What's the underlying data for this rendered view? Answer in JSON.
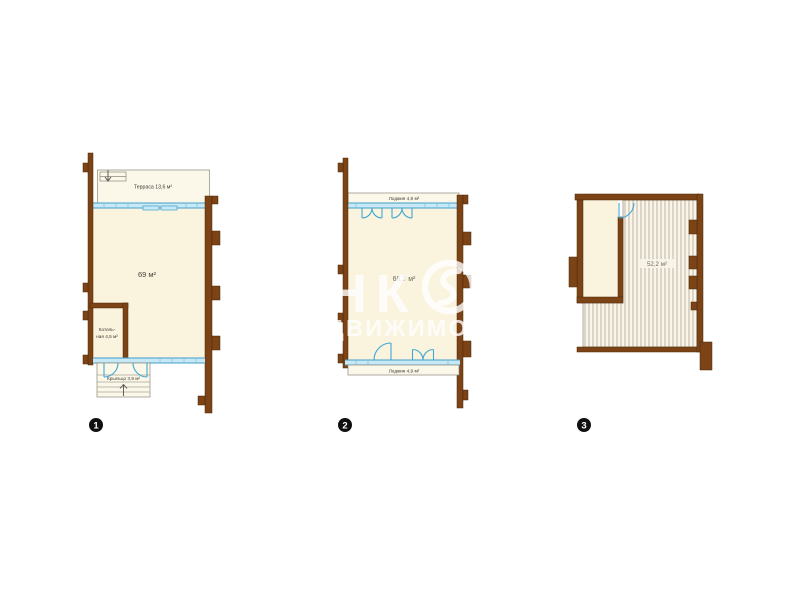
{
  "page": {
    "background": "#ffffff"
  },
  "palette": {
    "wall_brown": "#7b4316",
    "wall_outline": "#4e2809",
    "floor_cream": "#faf3de",
    "window_blue_fill": "#c8e8f5",
    "window_blue_line": "#3f9fc9",
    "door_blue": "#41a8d3",
    "hatch_line": "#d2cab9",
    "label_text": "#3e3a33",
    "badge_background": "#101010",
    "badge_text": "#ffffff",
    "watermark_white": "#ffffff"
  },
  "plans": [
    {
      "badge": "1",
      "terrace_label": "Терраса 13,6 м²",
      "main_area_label": "69 м²",
      "boiler_label_line1": "Котель-",
      "boiler_label_line2": "ная 4,5 м²",
      "porch_label": "Крыльцо 3,9 м²"
    },
    {
      "badge": "2",
      "loggia_top_label": "Лоджия 4,9 м²",
      "main_area_label": "66,7 м²",
      "loggia_bottom_label": "Лоджия 4,9 м²"
    },
    {
      "badge": "3",
      "attic_area_label": "52,2 м²"
    }
  ],
  "watermark": {
    "brand_part1": "ИНК",
    "brand_part2": "М",
    "subtitle": "НЕДВИЖИМОСТЬ"
  }
}
